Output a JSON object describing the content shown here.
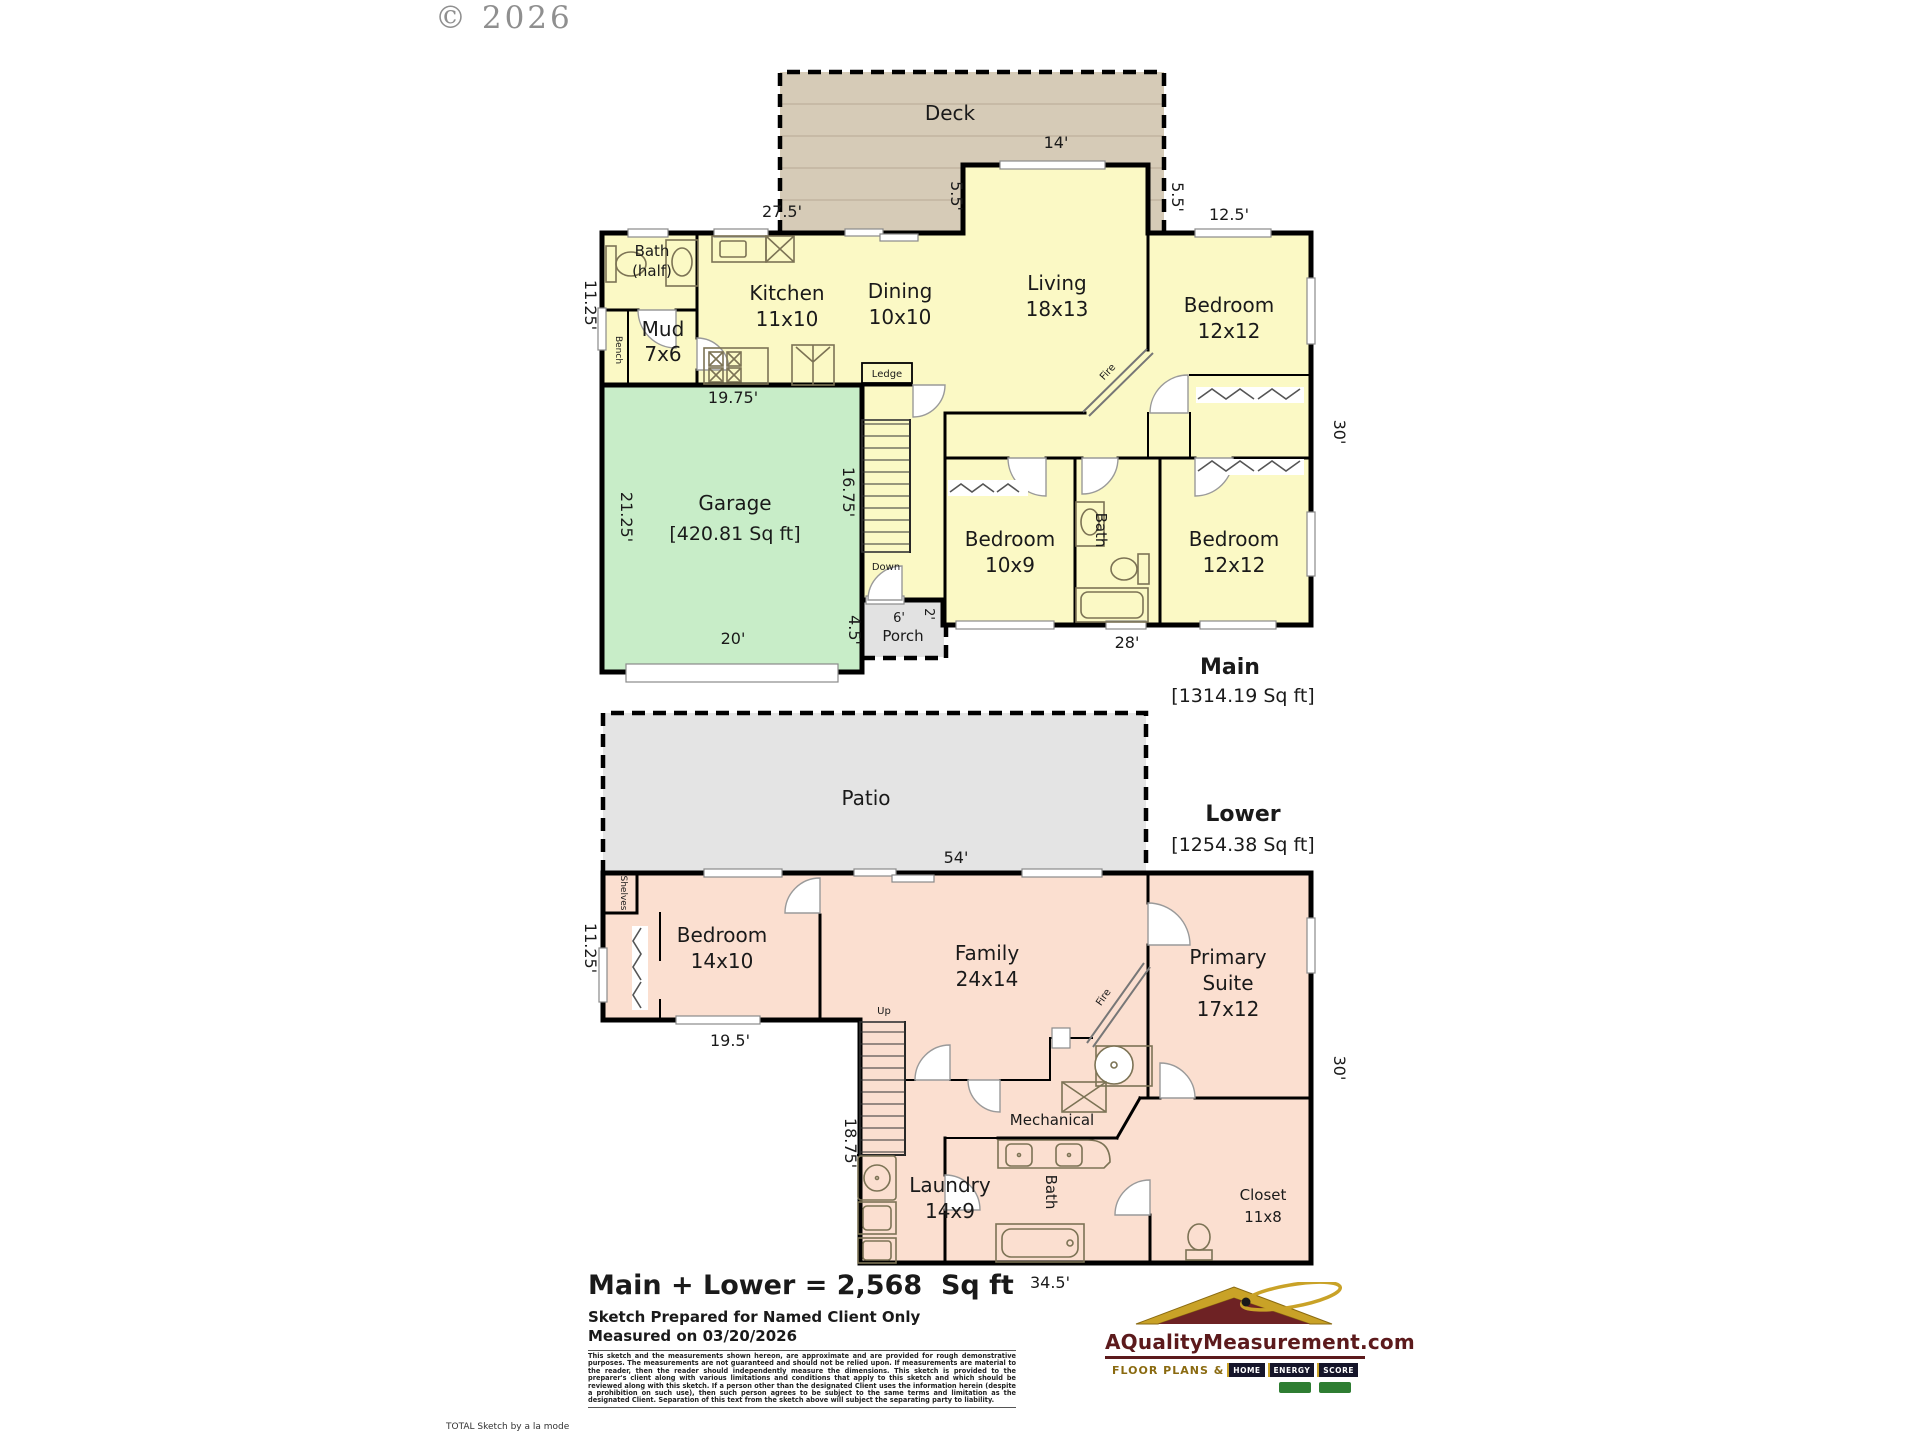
{
  "watermark": "© 2026",
  "colors": {
    "room_yellow": "#FBF9C5",
    "garage_green": "#C8EDC8",
    "lower_peach": "#FBDFD0",
    "deck_tan": "#D6CBB7",
    "patio_gray": "#E4E4E4",
    "porch_gray": "#E2E2E2",
    "logo_maroon": "#5C1A1C",
    "logo_gold": "#C9A227"
  },
  "main_floor": {
    "title": "Main",
    "area": "[1314.19 Sq ft]",
    "outdoor": {
      "deck": "Deck",
      "porch": "Porch"
    },
    "rooms": {
      "bath_half": {
        "line1": "Bath",
        "line2": "(half)"
      },
      "mud": {
        "name": "Mud",
        "size": "7x6"
      },
      "kitchen": {
        "name": "Kitchen",
        "size": "11x10"
      },
      "dining": {
        "name": "Dining",
        "size": "10x10"
      },
      "living": {
        "name": "Living",
        "size": "18x13"
      },
      "bedroom_ne": {
        "name": "Bedroom",
        "size": "12x12"
      },
      "bedroom_mid": {
        "name": "Bedroom",
        "size": "10x9"
      },
      "bath": {
        "name": "Bath"
      },
      "bedroom_se": {
        "name": "Bedroom",
        "size": "12x12"
      },
      "garage": {
        "name": "Garage",
        "size": "[420.81 Sq ft]"
      }
    },
    "annotations": {
      "bench": "Bench",
      "ledge": "Ledge",
      "fire": "Fire",
      "down": "Down"
    },
    "dimensions": {
      "top": "27.5'",
      "living_top": "14'",
      "living_left": "5.5'",
      "living_right": "5.5'",
      "bedroom_ne_top": "12.5'",
      "left": "11.25'",
      "garage_top": "19.75'",
      "garage_left": "21.25'",
      "stairwell": "16.75'",
      "garage_bottom": "20'",
      "garage_porch": "4.5'",
      "porch_width": "6'",
      "porch_depth": "2'",
      "bottom": "28'",
      "right": "30'"
    }
  },
  "lower_floor": {
    "title": "Lower",
    "area": "[1254.38 Sq ft]",
    "outdoor": {
      "patio": "Patio"
    },
    "rooms": {
      "bedroom": {
        "name": "Bedroom",
        "size": "14x10"
      },
      "family": {
        "name": "Family",
        "size": "24x14"
      },
      "primary": {
        "line1": "Primary",
        "line2": "Suite",
        "size": "17x12"
      },
      "laundry": {
        "name": "Laundry",
        "size": "14x9"
      },
      "bath": {
        "name": "Bath"
      },
      "closet": {
        "name": "Closet",
        "size": "11x8"
      },
      "mechanical": {
        "name": "Mechanical"
      }
    },
    "annotations": {
      "shelves": "Shelves",
      "up": "Up",
      "fire": "Fire"
    },
    "dimensions": {
      "width": "54'",
      "left_upper": "11.25'",
      "bedroom_bottom": "19.5'",
      "left_lower": "18.75'",
      "bottom": "34.5'",
      "right": "30'"
    }
  },
  "footer": {
    "total": "Main + Lower = 2,568  Sq ft",
    "prepared": "Sketch Prepared for Named Client Only",
    "measured": "Measured on 03/20/2026",
    "disclaimer": "This sketch and the measurements shown hereon, are approximate and are provided for rough demonstrative purposes.  The measurements are not guaranteed and should not be relied upon.  If measurements are material to the reader, then the reader should independently measure the dimensions.  This sketch is provided to the preparer's client along with various limitations and conditions that apply to this sketch and which should be reviewed along with this sketch.  If a person other than the designated Client uses the information herein (despite a prohibition on such use), then such person agrees to be subject to the same terms and limitation as the designated Client.  Separation of this text from the sketch above will subject the separating party to liability.",
    "credit": "TOTAL Sketch by a la mode"
  },
  "logo": {
    "site": "AQualityMeasurement.com",
    "tagline": "FLOOR PLANS &",
    "badges": [
      "HOME",
      "ENERGY",
      "SCORE"
    ]
  }
}
